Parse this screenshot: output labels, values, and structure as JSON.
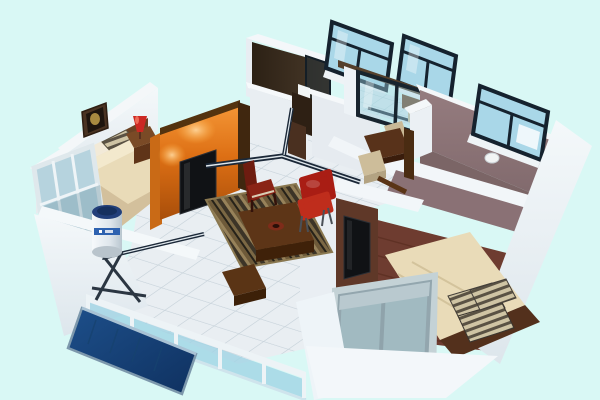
{
  "meta": {
    "description": "Isometric 3D dollhouse cutaway render of an apartment floor plan on a pale cyan background",
    "style": "3d-render",
    "background": "#d9f8f5"
  },
  "palette": {
    "bg": "#d9f8f5",
    "tile": "#e9eef2",
    "tile_grout": "#c7d2da",
    "stripe_navy": "#1b2838",
    "stripe_gap": "#dfe7ec",
    "wall_white": "#f4f7fa",
    "wall_face": "#e8edf2",
    "wall_shadow": "#ccd6de",
    "orange_light": "#f49636",
    "orange_mid": "#dd6f14",
    "orange_dark": "#a84e0a",
    "wood_cap": "#53330f",
    "tv_black": "#101215",
    "carpet_tan": "#d3c09c",
    "mattress_cream": "#e9dbb8",
    "pillow_light": "#f2ead8",
    "pillow_stripe": "#5a5244",
    "headboard_wood": "#6b4224",
    "nightstand_wood": "#7a4a26",
    "lamp_red": "#cc2823",
    "picture_frame": "#4a3322",
    "bath_dark": "#41311f",
    "glass_blue": "#a9d7e8",
    "glass_frame": "#15222e",
    "kitchen_floor": "#d7ebef",
    "counter_wood": "#6b4426",
    "mauve_wall": "#8d7578",
    "mauve_floor": "#7b6566",
    "wood_floor": "#6e3c30",
    "wood_floor_streak": "#582c20",
    "bedframe_wood": "#53301c",
    "rug_border": "#8a7850",
    "rug_stripe_1": "#3c3427",
    "rug_stripe_2": "#97825a",
    "rug_stripe_3": "#6e5a39",
    "rug_stripe_4": "#262219",
    "rug_stripe_5": "#7b6844",
    "coffee_table": "#5d3517",
    "dining_table": "#58321a",
    "chair_red": "#a91d14",
    "chair_maroon": "#6e1c10",
    "stool_beige": "#cdbd9a",
    "balcony_glass": "#9fd3e4",
    "rail_white": "#edf3f6",
    "panel_blue_deep": "#0f3160",
    "panel_blue": "#1d4f8a",
    "panel_frame": "#7d98ac",
    "tank_white": "#eef2f5",
    "tank_cap": "#223f7a",
    "tank_label": "#2e62b0",
    "gray_glass": "#9fb9c0",
    "gray_frame": "#8fa3ab",
    "toilet_white": "#f2f5f5"
  },
  "scene": {
    "rooms": [
      {
        "name": "bedroom-left",
        "items": [
          "double-bed",
          "striped-pillows",
          "wood-headboard",
          "framed-picture",
          "red-table-lamp",
          "nightstand",
          "leaning-window"
        ]
      },
      {
        "name": "living-room",
        "items": [
          "orange-tv-feature-wall",
          "wall-tv",
          "spot-light-glow",
          "striped-rug",
          "coffee-table",
          "red-chair",
          "maroon-chair",
          "wood-bench",
          "tiled-floor",
          "navy-floor-inlay"
        ]
      },
      {
        "name": "bathroom",
        "items": [
          "dark-walls",
          "toilet",
          "glass-shower-screen",
          "tilted-window",
          "open-door"
        ]
      },
      {
        "name": "kitchen",
        "items": [
          "glass-sliding-doors",
          "tilted-window",
          "counter",
          "blue-tile-floor"
        ]
      },
      {
        "name": "dining-nook",
        "items": [
          "dining-table",
          "beige-stools",
          "wood-chair-post"
        ]
      },
      {
        "name": "bedroom-right-top",
        "items": [
          "mauve-wall",
          "tilted-window",
          "wall-lamp"
        ]
      },
      {
        "name": "bedroom-right-bottom",
        "items": [
          "double-bed",
          "striped-cushions",
          "dark-wood-floor",
          "wall-tv",
          "front-window"
        ]
      },
      {
        "name": "balcony",
        "items": [
          "glass-railing",
          "white-posts",
          "solar-water-heater-tank",
          "solar-collector-panel",
          "tiled-floor"
        ]
      }
    ]
  }
}
